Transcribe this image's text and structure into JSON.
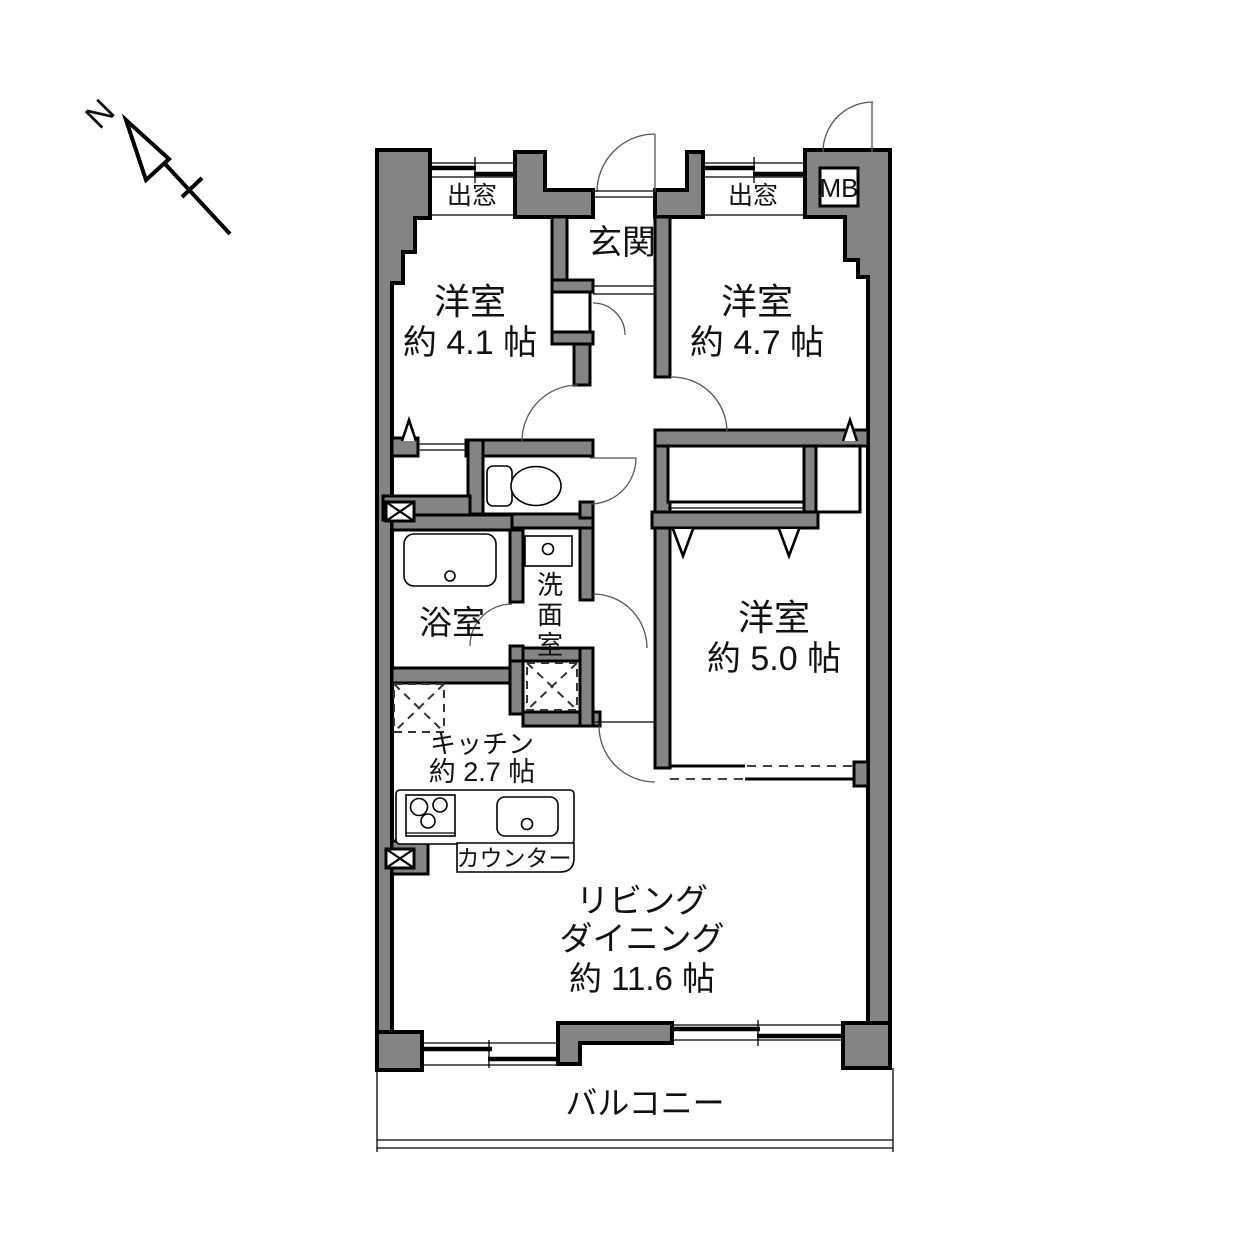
{
  "compass": {
    "north_label": "N"
  },
  "colors": {
    "wall_fill": "#848484",
    "outline": "#000000"
  },
  "rooms": {
    "bedroom_41": {
      "name": "洋室",
      "size": "約 4.1 帖"
    },
    "bedroom_47": {
      "name": "洋室",
      "size": "約 4.7 帖"
    },
    "bedroom_50": {
      "name": "洋室",
      "size": "約 5.0 帖"
    },
    "entrance": {
      "name": "玄関"
    },
    "bath": {
      "name": "浴室"
    },
    "washroom": {
      "char1": "洗",
      "char2": "面",
      "char3": "室"
    },
    "kitchen": {
      "name": "キッチン",
      "size": "約 2.7 帖"
    },
    "living_dining": {
      "name_line1": "リビング",
      "name_line2": "ダイニング",
      "size": "約 11.6 帖"
    },
    "balcony": {
      "name": "バルコニー"
    }
  },
  "features": {
    "bay_window_left": "出窓",
    "bay_window_right": "出窓",
    "meter_box": "MB",
    "counter": "カウンター"
  }
}
